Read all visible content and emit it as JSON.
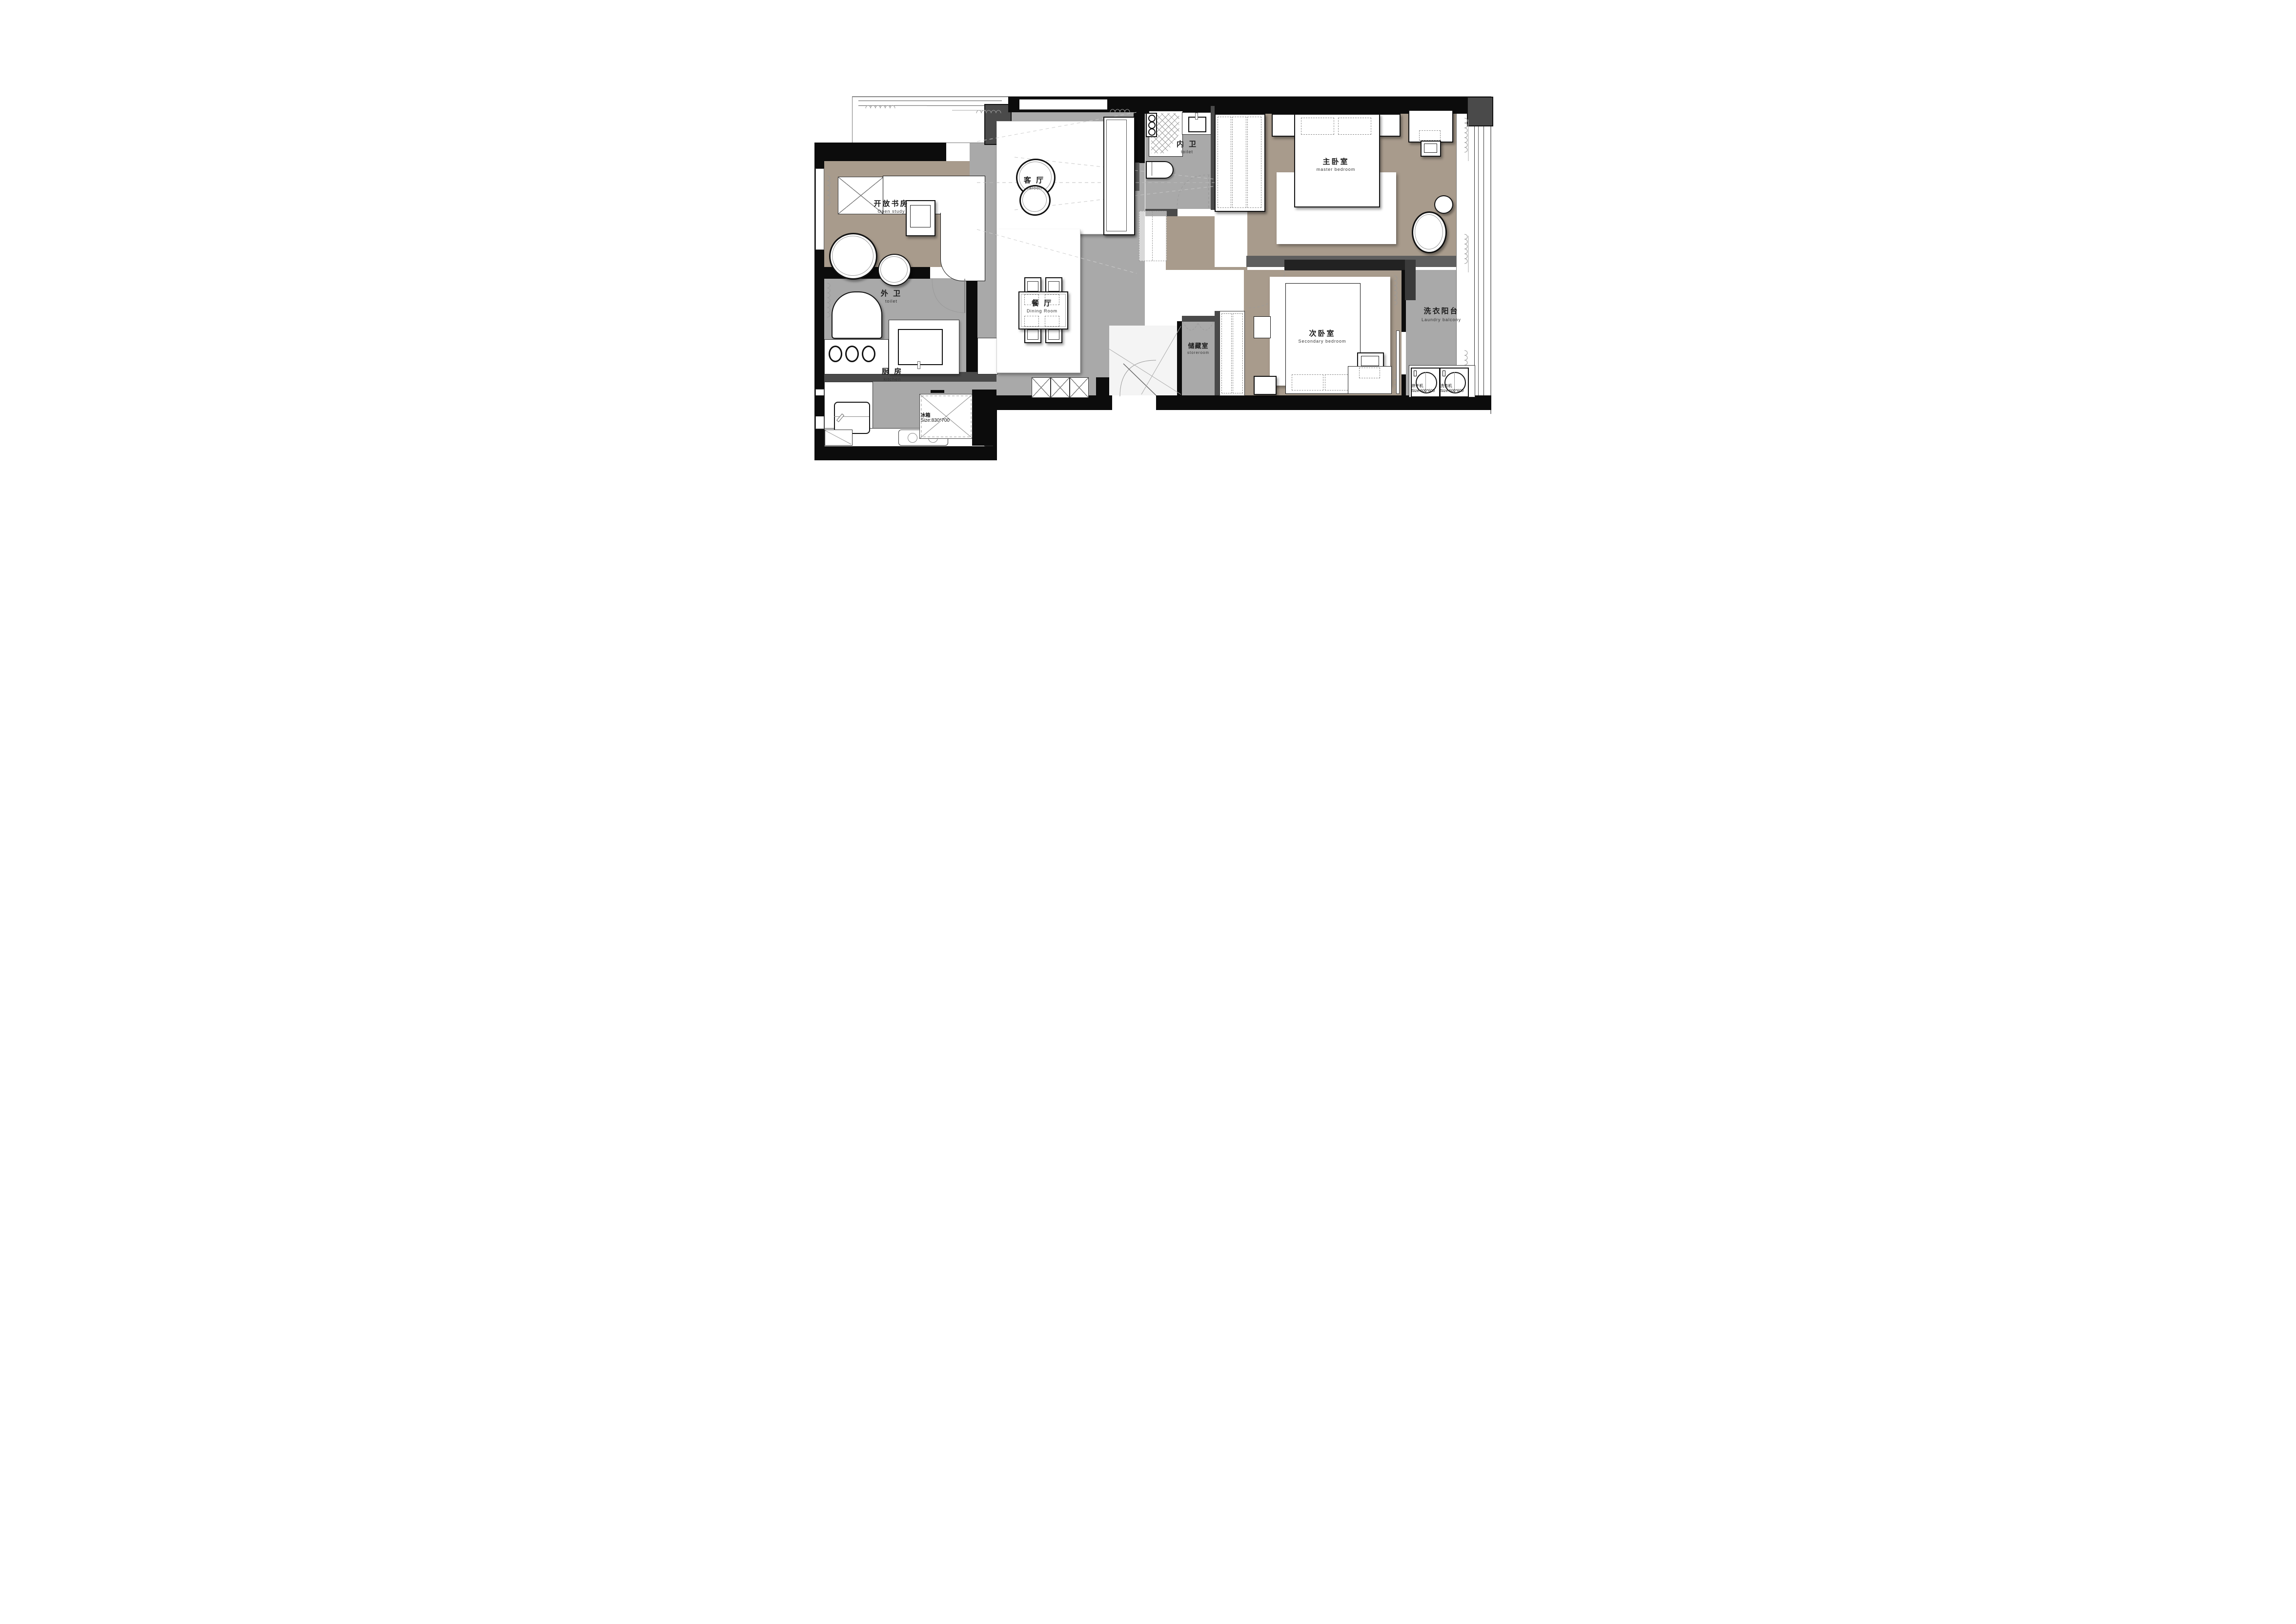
{
  "title": "apartment floor plan",
  "colors": {
    "floor_tan": "#a89b8c",
    "floor_gray": "#a9a9a9",
    "wall_black": "#0c0c0c",
    "wall_gray": "#4a4a4a",
    "furniture_white": "#ffffff"
  },
  "rooms": {
    "open_study": {
      "cn": "开放书房",
      "en": "Open study"
    },
    "saloon": {
      "cn": "客 厅",
      "en": "saloon"
    },
    "inner_toilet": {
      "cn": "内 卫",
      "en": "toilet"
    },
    "master_bedroom": {
      "cn": "主卧室",
      "en": "master bedroom"
    },
    "outer_toilet": {
      "cn": "外 卫",
      "en": "toilet"
    },
    "dining_room": {
      "cn": "餐 厅",
      "en": "Dining Room"
    },
    "storeroom": {
      "cn": "储藏室",
      "en": "storeroom"
    },
    "secondary_bedroom": {
      "cn": "次卧室",
      "en": "Secondary bedroom"
    },
    "laundry_balcony": {
      "cn": "洗衣阳台",
      "en": "Laundry balcony"
    },
    "kitchen": {
      "cn": "厨 房",
      "en": "kitchen"
    }
  },
  "appliances": {
    "fridge": {
      "cn": "冰箱",
      "size": "Size:830*700"
    },
    "dryer": {
      "cn": "烘干机",
      "size": "Size:600*600"
    },
    "washer": {
      "cn": "洗衣机",
      "size": "Size:600*600"
    }
  }
}
